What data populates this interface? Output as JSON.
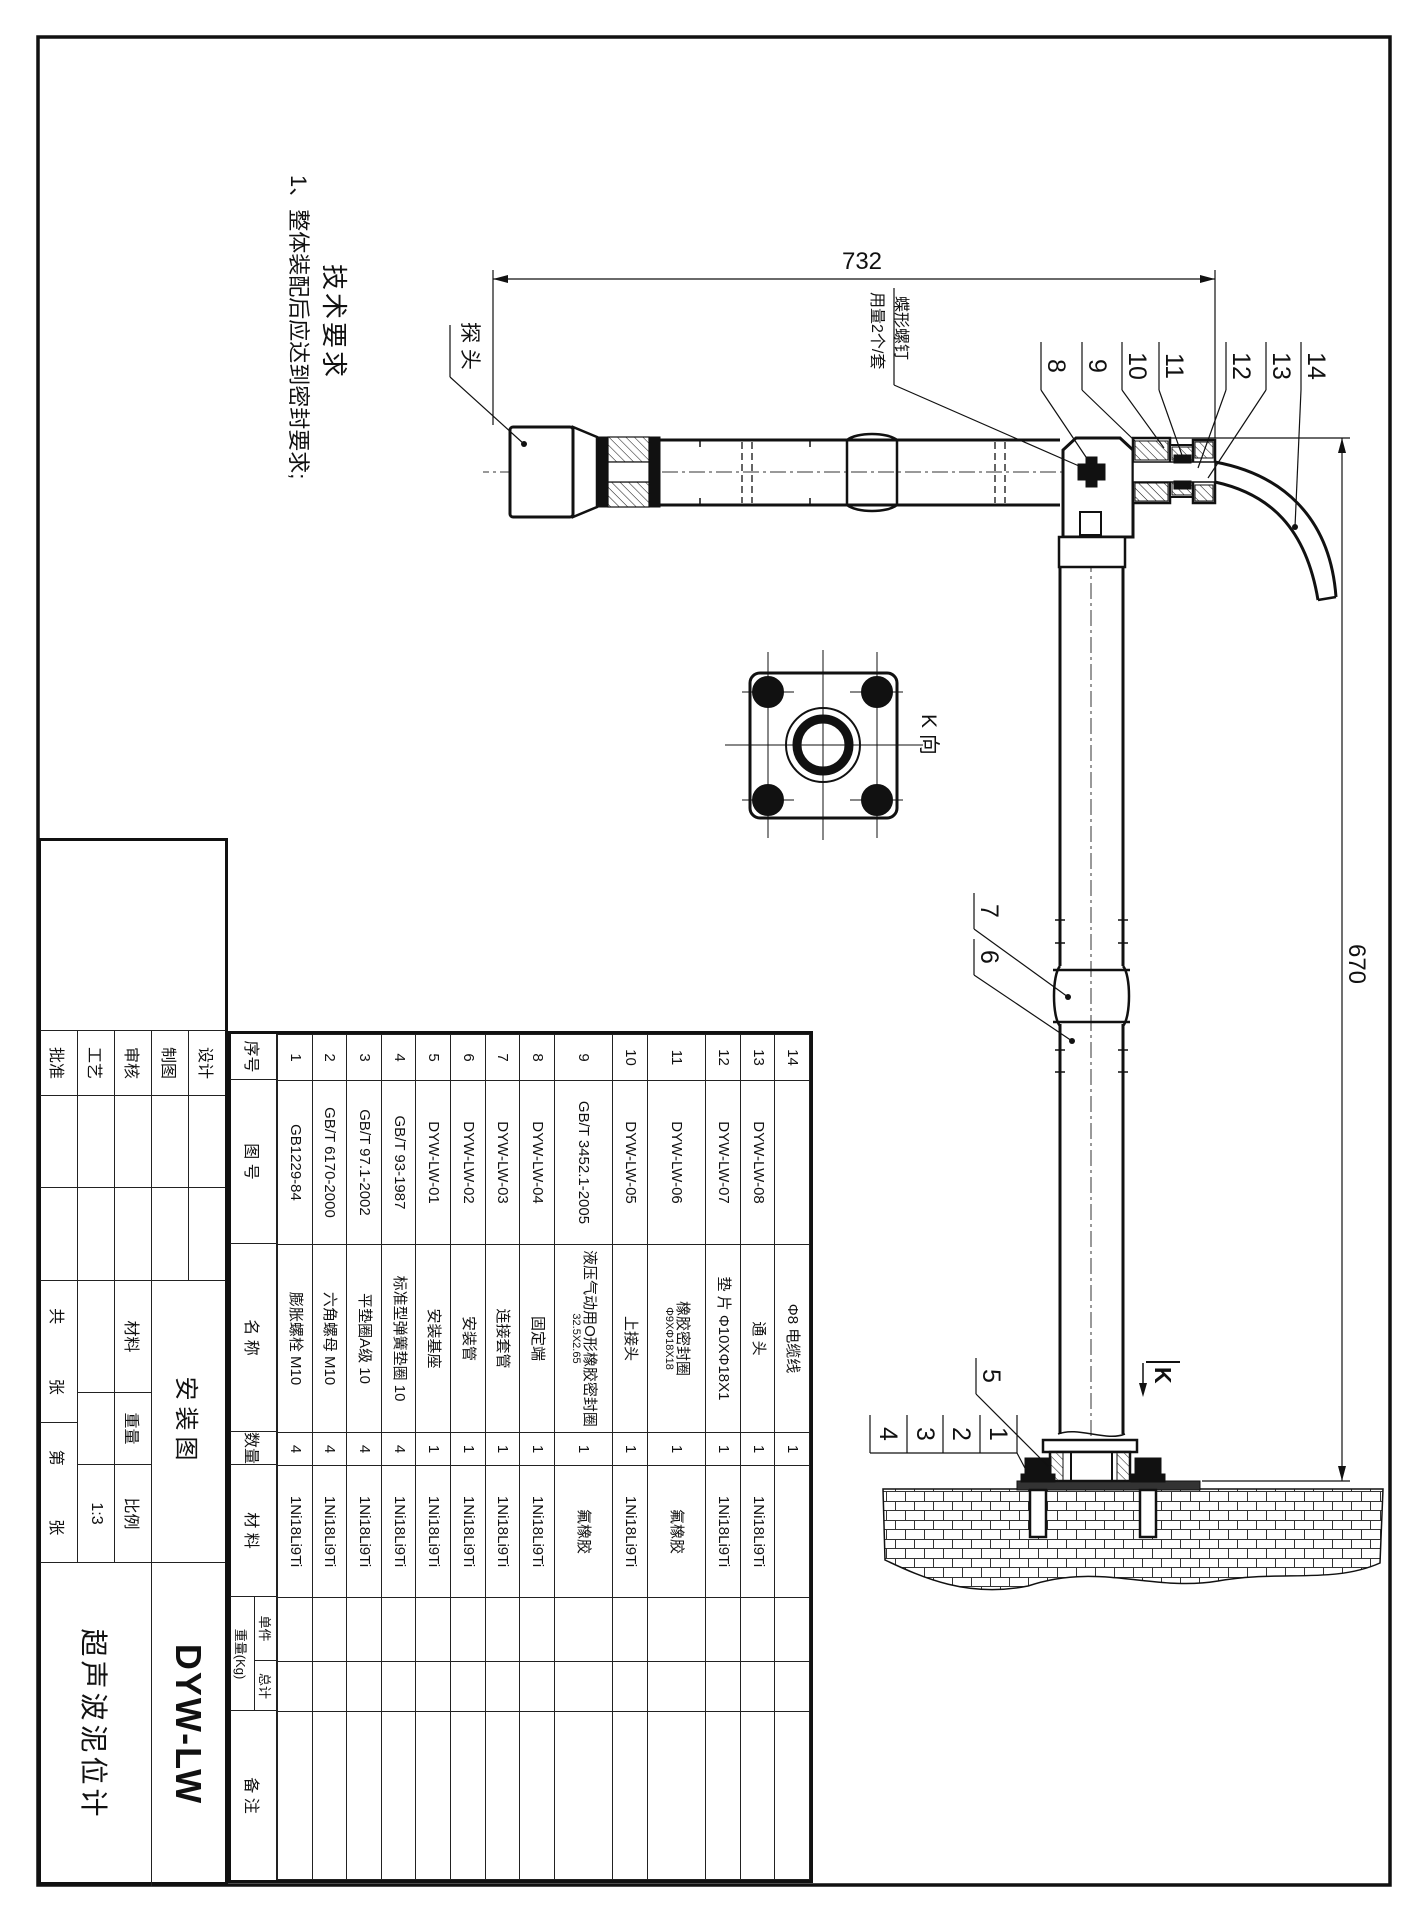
{
  "sheet": {
    "title_drawing": "安装图",
    "model": "DYW-LW",
    "product_name": "超声波泥位计",
    "sign_rows": [
      "设计",
      "制图",
      "审核",
      "工艺",
      "批准"
    ],
    "material_label": "材料",
    "weight_label": "重量",
    "scale_label": "比例",
    "scale_value": "1:3",
    "total_label": "共",
    "sheet_label": "张",
    "no_label": "第",
    "sheet_label2": "张"
  },
  "tech_req": {
    "heading": "技术要求",
    "items": [
      "1、整体装配后应达到密封要求;"
    ]
  },
  "dimensions": {
    "length_732": "732",
    "length_670": "670"
  },
  "labels": {
    "probe": "探 头",
    "wing_screw_line1": "蝶形螺钉",
    "wing_screw_line2": "用量2个/套",
    "k_view": "K 向",
    "k_arrow": "K"
  },
  "callouts": [
    "1",
    "2",
    "3",
    "4",
    "5",
    "6",
    "7",
    "8",
    "9",
    "10",
    "11",
    "12",
    "13",
    "14"
  ],
  "parts_table": {
    "headers": {
      "seq": "序号",
      "code": "图  号",
      "name": "名  称",
      "qty": "数量",
      "material": "材  料",
      "weight": "重量(Kg)",
      "unit": "单件",
      "total": "总计",
      "remark": "备  注"
    },
    "rows": [
      {
        "seq": "14",
        "code": "",
        "name": "Φ8 电缆线",
        "name2": "",
        "qty": "1",
        "mat": "",
        "unit": "",
        "total": "",
        "remark": ""
      },
      {
        "seq": "13",
        "code": "DYW-LW-08",
        "name": "通 头",
        "name2": "",
        "qty": "1",
        "mat": "1Ni18Li9Ti",
        "unit": "",
        "total": "",
        "remark": ""
      },
      {
        "seq": "12",
        "code": "DYW-LW-07",
        "name": "垫 片 Φ10XΦ18X1",
        "name2": "",
        "qty": "1",
        "mat": "1Ni18Li9Ti",
        "unit": "",
        "total": "",
        "remark": ""
      },
      {
        "seq": "11",
        "code": "DYW-LW-06",
        "name": "橡胶密封圈",
        "name2": "Φ9XΦ18X18",
        "qty": "1",
        "mat": "氟橡胶",
        "unit": "",
        "total": "",
        "remark": ""
      },
      {
        "seq": "10",
        "code": "DYW-LW-05",
        "name": "上接头",
        "name2": "",
        "qty": "1",
        "mat": "1Ni18Li9Ti",
        "unit": "",
        "total": "",
        "remark": ""
      },
      {
        "seq": "9",
        "code": "GB/T 3452.1-2005",
        "name": "液压气动用O形橡胶密封圈",
        "name2": "32.5X2.65",
        "qty": "1",
        "mat": "氟橡胶",
        "unit": "",
        "total": "",
        "remark": ""
      },
      {
        "seq": "8",
        "code": "DYW-LW-04",
        "name": "固定端",
        "name2": "",
        "qty": "1",
        "mat": "1Ni18Li9Ti",
        "unit": "",
        "total": "",
        "remark": ""
      },
      {
        "seq": "7",
        "code": "DYW-LW-03",
        "name": "连接套管",
        "name2": "",
        "qty": "1",
        "mat": "1Ni18Li9Ti",
        "unit": "",
        "total": "",
        "remark": ""
      },
      {
        "seq": "6",
        "code": "DYW-LW-02",
        "name": "安装管",
        "name2": "",
        "qty": "1",
        "mat": "1Ni18Li9Ti",
        "unit": "",
        "total": "",
        "remark": ""
      },
      {
        "seq": "5",
        "code": "DYW-LW-01",
        "name": "安装基座",
        "name2": "",
        "qty": "1",
        "mat": "1Ni18Li9Ti",
        "unit": "",
        "total": "",
        "remark": ""
      },
      {
        "seq": "4",
        "code": "GB/T 93-1987",
        "name": "标准型弹簧垫圈 10",
        "name2": "",
        "qty": "4",
        "mat": "1Ni18Li9Ti",
        "unit": "",
        "total": "",
        "remark": ""
      },
      {
        "seq": "3",
        "code": "GB/T 97.1-2002",
        "name": "平垫圈A级 10",
        "name2": "",
        "qty": "4",
        "mat": "1Ni18Li9Ti",
        "unit": "",
        "total": "",
        "remark": ""
      },
      {
        "seq": "2",
        "code": "GB/T 6170-2000",
        "name": "六角螺母 M10",
        "name2": "",
        "qty": "4",
        "mat": "1Ni18Li9Ti",
        "unit": "",
        "total": "",
        "remark": ""
      },
      {
        "seq": "1",
        "code": "GB1229-84",
        "name": "膨胀螺栓 M10",
        "name2": "",
        "qty": "4",
        "mat": "1Ni18Li9Ti",
        "unit": "",
        "total": "",
        "remark": ""
      }
    ]
  }
}
